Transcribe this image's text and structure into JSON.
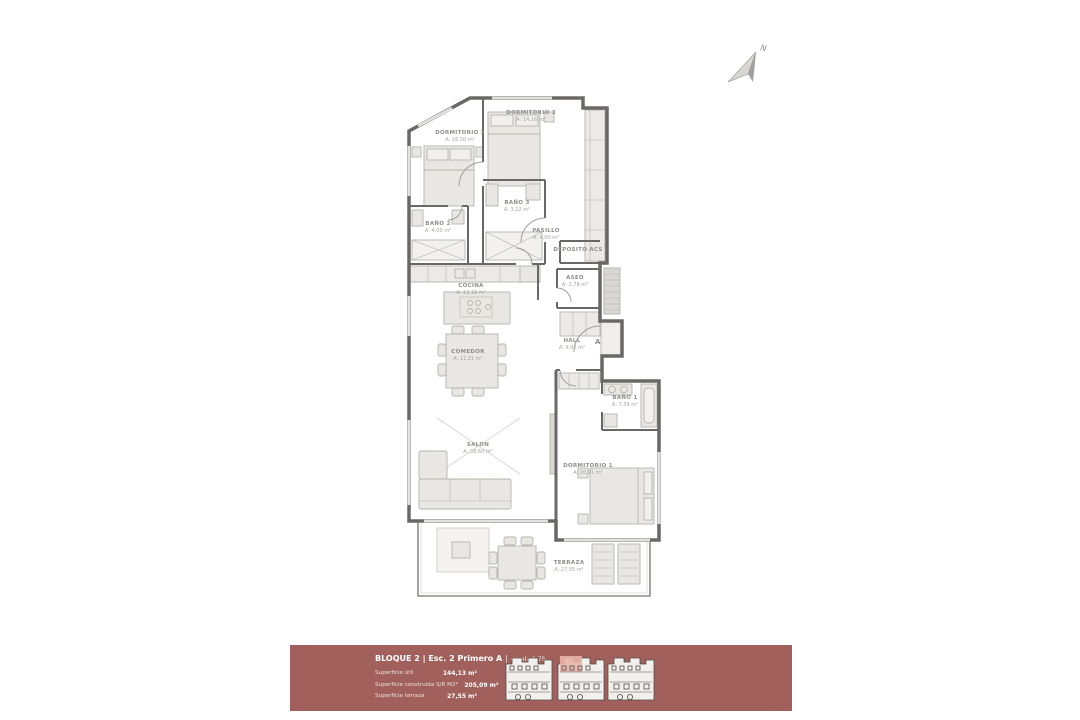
{
  "plan": {
    "rooms": [
      {
        "name": "DORMITORIO 3",
        "area": "A: 14,16 m²"
      },
      {
        "name": "DORMITORIO 2",
        "area": "A: 16,50 m²"
      },
      {
        "name": "BAÑO 3",
        "area": "A: 3,22 m²"
      },
      {
        "name": "BAÑO 2",
        "area": "A: 4,00 m²"
      },
      {
        "name": "PASILLO",
        "area": "A: 4,00 m²"
      },
      {
        "name": "DEPOSITO ACS",
        "area": ""
      },
      {
        "name": "COCINA",
        "area": "A: 12,16 m²"
      },
      {
        "name": "ASEO",
        "area": "A: 2,78 m²"
      },
      {
        "name": "COMEDOR",
        "area": "A: 11,21 m²"
      },
      {
        "name": "HALL",
        "area": "A: 9,96 m²"
      },
      {
        "name": "BAÑO 1",
        "area": "A: 7,39 m²"
      },
      {
        "name": "SALON",
        "area": "A: 38,60 m²"
      },
      {
        "name": "DORMITORIO 1",
        "area": "A: 20,91 m²"
      },
      {
        "name": "TERRAZA",
        "area": "A: 27,55 m²"
      }
    ],
    "entry_door_label": "A"
  },
  "compass": {
    "label": "N"
  },
  "footer": {
    "title_main": "BLOQUE 2 | Esc. 2 Primero A",
    "title_sep": "|",
    "title_scale": "escala 1:75",
    "rows": [
      {
        "label": "Superficie útil",
        "value": "144,13 m²"
      },
      {
        "label": "Superficie construida S/R M2*",
        "value": "205,09 m²"
      },
      {
        "label": "Superficie terraza",
        "value": "27,55 m²"
      }
    ],
    "colors": {
      "bar": "#a1605b",
      "highlight": "#e9b4aa"
    }
  }
}
